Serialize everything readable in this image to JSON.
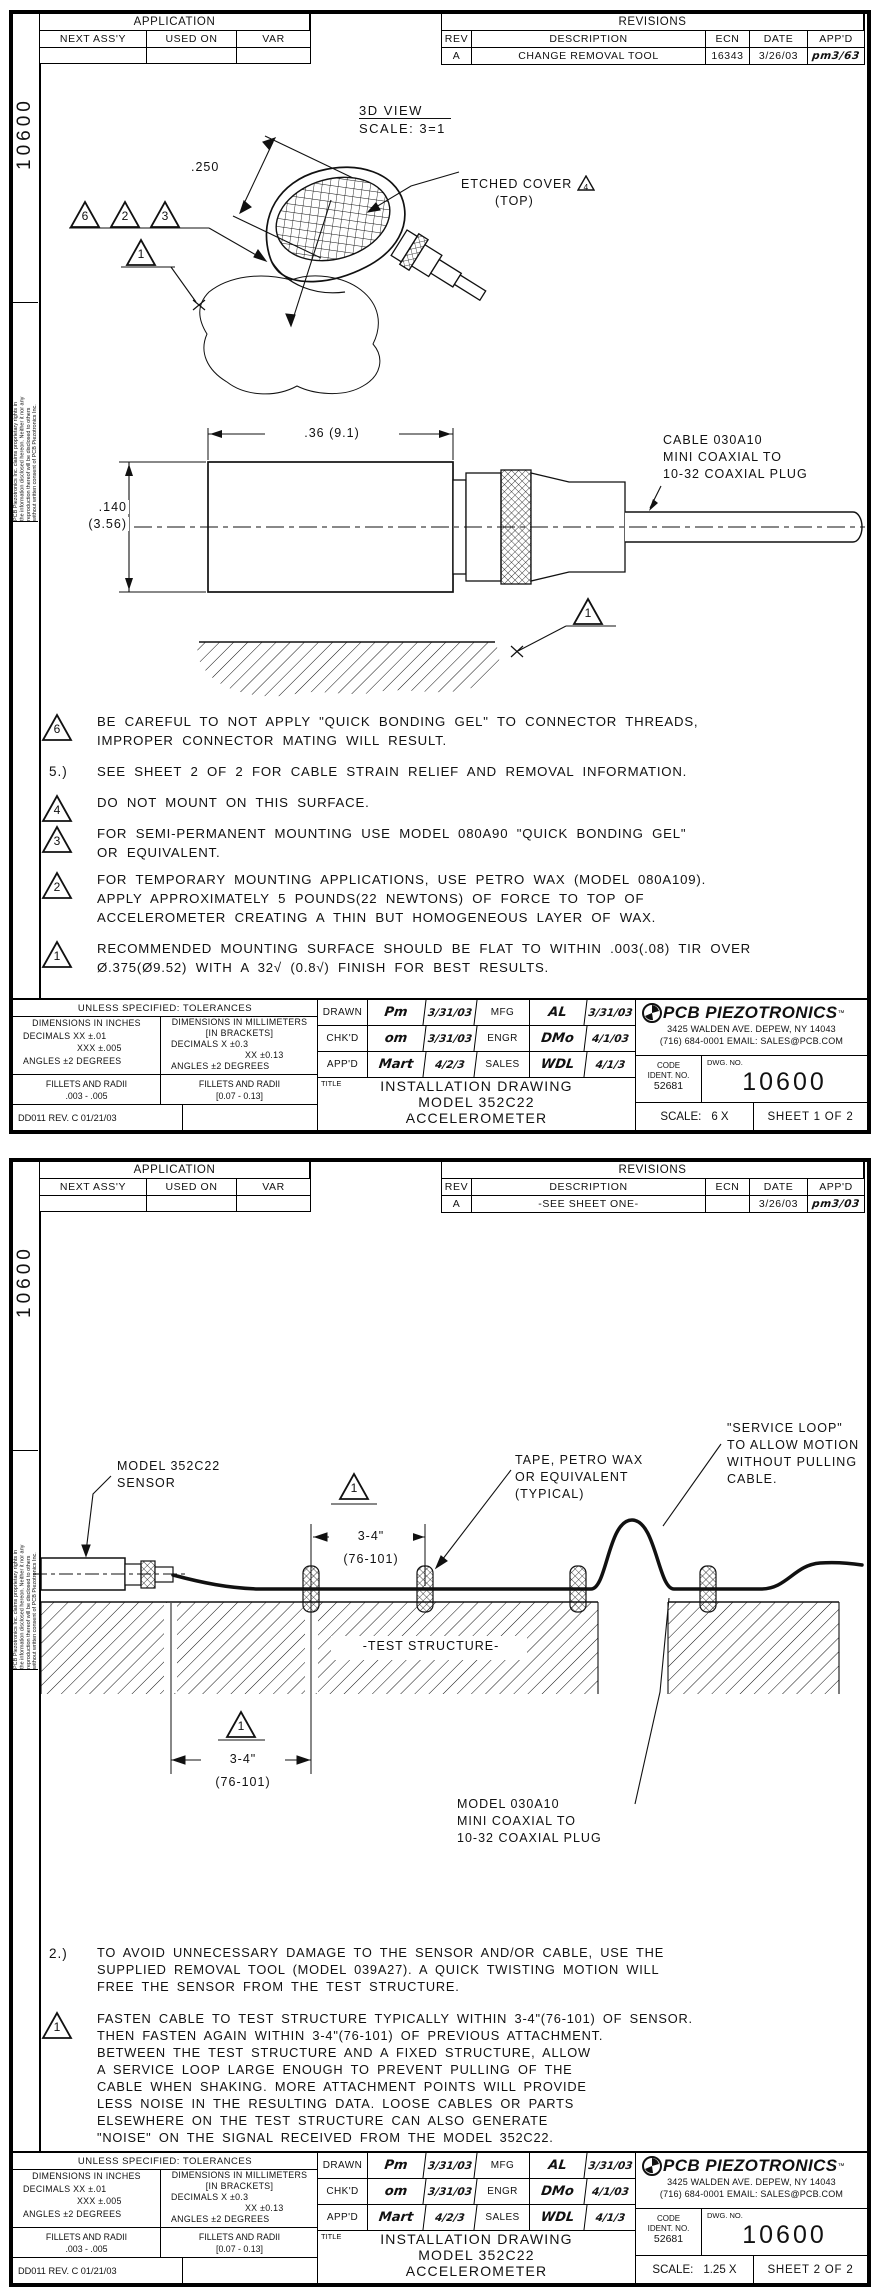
{
  "shared": {
    "side_number": "10600",
    "proprietary": "PCB Piezotronics Inc. claims proprietary rights in\nthe information disclosed hereon. Neither it nor any\nreproduction thereof will be disclosed to others\nwithout written consent of PCB Piezotronics Inc.",
    "application": {
      "title": "APPLICATION",
      "col_next_assy": "NEXT ASS'Y",
      "col_used_on": "USED ON",
      "col_var": "VAR"
    },
    "revisions": {
      "title": "REVISIONS",
      "col_rev": "REV",
      "col_desc": "DESCRIPTION",
      "col_ecn": "ECN",
      "col_date": "DATE",
      "col_appd": "APP'D"
    },
    "titleblock": {
      "tol_header": "UNLESS SPECIFIED: TOLERANCES",
      "in_header": "DIMENSIONS IN INCHES",
      "in_l1": "DECIMALS   XX ±.01",
      "in_l2": "XXX ±.005",
      "in_l3": "ANGLES ±2 DEGREES",
      "mm_header": "DIMENSIONS IN MILLIMETERS",
      "mm_sub": "[IN BRACKETS]",
      "mm_l1": "DECIMALS   X ±0.3",
      "mm_l2": "XX ±0.13",
      "mm_l3": "ANGLES ±2 DEGREES",
      "fillets_in_label": "FILLETS AND RADII",
      "fillets_in_value": ".003 - .005",
      "fillets_mm_label": "FILLETS AND RADII",
      "fillets_mm_value": "[0.07 - 0.13]",
      "form_ref": "DD011 REV. C 01/21/03",
      "signoff": {
        "drawn_label": "DRAWN",
        "drawn_sig": "Pm",
        "drawn_date": "3/31/03",
        "mfg_label": "MFG",
        "mfg_sig": "AL",
        "mfg_date": "3/31/03",
        "chkd_label": "CHK'D",
        "chkd_sig": "om",
        "chkd_date": "3/31/03",
        "engr_label": "ENGR",
        "engr_sig": "DMo",
        "engr_date": "4/1/03",
        "appd_label": "APP'D",
        "appd_sig": "Mart",
        "appd_date": "4/2/3",
        "sales_label": "SALES",
        "sales_sig": "WDL",
        "sales_date": "4/1/3"
      },
      "title_label": "TITLE",
      "title_line1": "INSTALLATION DRAWING",
      "title_line2": "MODEL 352C22",
      "title_line3": "ACCELEROMETER",
      "company": "PCB PIEZOTRONICS",
      "company_tm": "™",
      "address_line1": "3425 WALDEN AVE. DEPEW, NY 14043",
      "address_line2": "(716) 684-0001 EMAIL: SALES@PCB.COM",
      "code_label": "CODE",
      "code_sub": "IDENT. NO.",
      "code_value": "52681",
      "dwg_label": "DWG. NO.",
      "dwg_no": "10600",
      "scale_label": "SCALE:"
    }
  },
  "sheet1": {
    "revision": {
      "rev": "A",
      "description": "CHANGE REMOVAL TOOL",
      "ecn": "16343",
      "date": "3/26/03",
      "appd": "pm3/63"
    },
    "view_title": "3D VIEW",
    "view_scale": "SCALE:  3=1",
    "dim_250": ".250",
    "etched_cover": "ETCHED COVER",
    "etched_flag": "4",
    "etched_top": "(TOP)",
    "flag_a": "6",
    "flag_b": "2",
    "flag_c": "3",
    "flag_blob": "1",
    "flag_surface": "1",
    "dim_width": ".36  (9.1)",
    "dim_height_in": ".140",
    "dim_height_mm": "(3.56)",
    "cable_callout": "CABLE 030A10\nMINI COAXIAL TO\n10-32 COAXIAL PLUG",
    "note6_flag": "6",
    "note6": "BE CAREFUL TO NOT APPLY \"QUICK BONDING GEL\" TO CONNECTOR THREADS,\nIMPROPER CONNECTOR MATING WILL RESULT.",
    "note5_num": "5.)",
    "note5": "SEE SHEET 2 OF 2 FOR CABLE STRAIN RELIEF AND REMOVAL INFORMATION.",
    "note4_flag": "4",
    "note4": "DO NOT MOUNT ON THIS SURFACE.",
    "note3_flag": "3",
    "note3": "FOR SEMI-PERMANENT MOUNTING USE MODEL 080A90 \"QUICK BONDING GEL\"\nOR EQUIVALENT.",
    "note2_flag": "2",
    "note2": "FOR TEMPORARY MOUNTING APPLICATIONS, USE PETRO WAX (MODEL 080A109).\nAPPLY APPROXIMATELY 5 POUNDS(22 NEWTONS) OF FORCE TO TOP OF\nACCELEROMETER CREATING A THIN BUT HOMOGENEOUS LAYER OF WAX.",
    "note1_flag": "1",
    "note1": "RECOMMENDED MOUNTING SURFACE SHOULD BE FLAT TO WITHIN .003(.08) TIR OVER\nØ.375(Ø9.52) WITH A 32√ (0.8√) FINISH FOR BEST RESULTS.",
    "scale_value": "6 X",
    "sheet_label": "SHEET 1 OF 2"
  },
  "sheet2": {
    "revision": {
      "rev": "A",
      "description": "-SEE SHEET ONE-",
      "ecn": "",
      "date": "3/26/03",
      "appd": "pm3/03"
    },
    "sensor_callout": "MODEL 352C22\nSENSOR",
    "tape_callout": "TAPE, PETRO WAX\nOR EQUIVALENT\n(TYPICAL)",
    "service_loop_callout": "\"SERVICE LOOP\"\nTO ALLOW MOTION\nWITHOUT PULLING\nCABLE.",
    "test_structure_label": "-TEST STRUCTURE-",
    "plug_callout": "MODEL 030A10\nMINI COAXIAL TO\n10-32 COAXIAL PLUG",
    "flag_top": "1",
    "dim_top": "3-4\"",
    "dim_top_mm": "(76-101)",
    "flag_bottom": "1",
    "dim_bottom": "3-4\"",
    "dim_bottom_mm": "(76-101)",
    "note2_num": "2.)",
    "note2": "TO AVOID UNNECESSARY DAMAGE TO THE SENSOR AND/OR  CABLE, USE THE\nSUPPLIED REMOVAL TOOL (MODEL 039A27).  A QUICK TWISTING MOTION WILL\nFREE THE SENSOR FROM THE TEST STRUCTURE.",
    "note1_flag": "1",
    "note1": "FASTEN CABLE TO TEST STRUCTURE TYPICALLY WITHIN 3-4\"(76-101) OF SENSOR.\nTHEN FASTEN AGAIN WITHIN 3-4\"(76-101) OF PREVIOUS ATTACHMENT.\nBETWEEN THE TEST STRUCTURE AND A FIXED STRUCTURE, ALLOW\nA SERVICE LOOP LARGE ENOUGH TO PREVENT PULLING OF THE\nCABLE WHEN SHAKING. MORE ATTACHMENT POINTS WILL PROVIDE\nLESS NOISE IN THE RESULTING DATA. LOOSE CABLES OR PARTS\nELSEWHERE ON THE TEST STRUCTURE CAN ALSO GENERATE\n\"NOISE\" ON THE SIGNAL RECEIVED FROM THE MODEL 352C22.",
    "scale_value": "1.25 X",
    "sheet_label": "SHEET 2 OF 2"
  }
}
